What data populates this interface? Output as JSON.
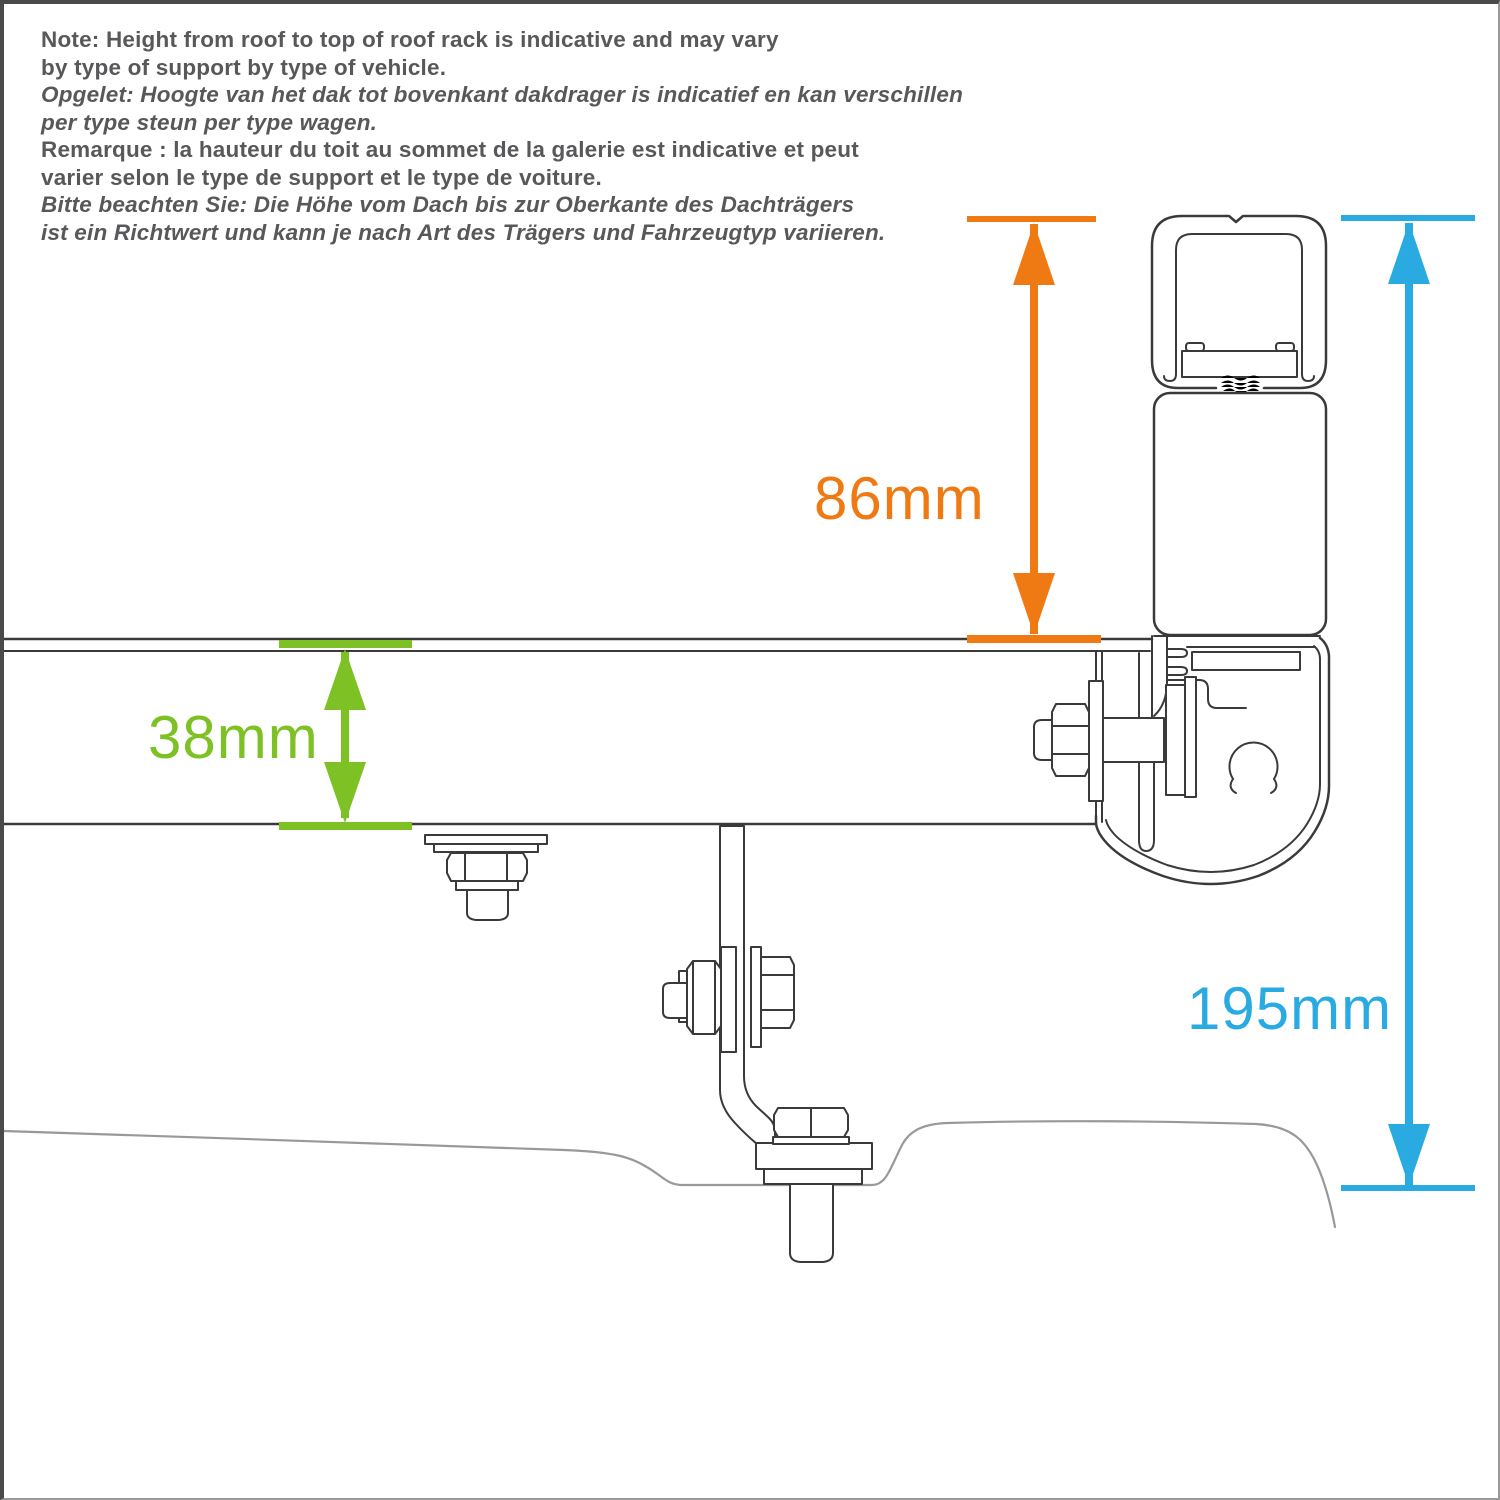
{
  "note": {
    "lines": [
      {
        "text": "Note: Height from roof to top of roof rack is indicative and may vary",
        "lang": "en",
        "italic": false
      },
      {
        "text": "by type of support by type of vehicle.",
        "lang": "en",
        "italic": false
      },
      {
        "text": "Opgelet: Hoogte van het dak tot bovenkant dakdrager is indicatief en kan verschillen",
        "lang": "nl",
        "italic": true
      },
      {
        "text": "per type steun per type wagen.",
        "lang": "nl",
        "italic": true
      },
      {
        "text": "Remarque : la hauteur du toit au sommet de la galerie est indicative et peut",
        "lang": "fr",
        "italic": false
      },
      {
        "text": "varier selon le type de support et le type de voiture.",
        "lang": "fr",
        "italic": false
      },
      {
        "text": "Bitte beachten Sie: Die Höhe vom Dach bis zur Oberkante des Dachträgers",
        "lang": "de",
        "italic": true
      },
      {
        "text": "ist ein Richtwert und kann je nach Art des Trägers und Fahrzeugtyp variieren.",
        "lang": "de",
        "italic": true
      }
    ]
  },
  "dimensions": {
    "rack_height": {
      "label": "86mm",
      "color": "#EF7A14",
      "measures": "roof-rack rail top to top of crossbar"
    },
    "rail_thickness": {
      "label": "38mm",
      "color": "#7DC125",
      "measures": "platform rail profile height"
    },
    "total_height": {
      "label": "195mm",
      "color": "#29ABE2",
      "measures": "vehicle roof to top of crossbar"
    }
  },
  "colors": {
    "orange": "#EF7A14",
    "green": "#7DC125",
    "blue": "#29ABE2",
    "note-text": "#58585A",
    "line": "#3A3A3A",
    "roof-line": "#999999"
  }
}
